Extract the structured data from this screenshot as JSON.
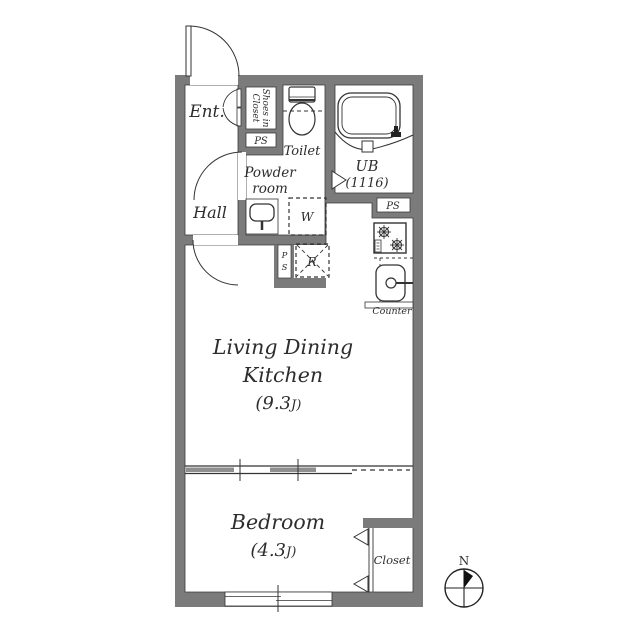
{
  "floorplan": {
    "rooms": {
      "entrance": {
        "label": "Ent."
      },
      "hall": {
        "label": "Hall"
      },
      "shoes_closet": {
        "line1": "Shoes in",
        "line2": "Closet"
      },
      "toilet": {
        "label": "Toilet"
      },
      "powder_room": {
        "line1": "Powder",
        "line2": "room"
      },
      "unit_bath": {
        "line1": "UB",
        "line2": "(1116)"
      },
      "living_dining_kitchen": {
        "line1": "Living Dining",
        "line2": "Kitchen",
        "area_value": "(9.3",
        "area_unit": "J)"
      },
      "bedroom": {
        "label": "Bedroom",
        "area_value": "(4.3",
        "area_unit": "J)"
      },
      "closet": {
        "label": "Closet"
      }
    },
    "labels": {
      "ps_top": "PS",
      "ps_kitchen": "PS",
      "ps_vertical_p": "P",
      "ps_vertical_s": "S",
      "washer": "W",
      "refrigerator": "R",
      "counter": "Counter",
      "compass_north": "N"
    },
    "colors": {
      "wall": "#7b7b7b",
      "line": "#333333",
      "text": "#2d2d2d",
      "background": "#ffffff"
    }
  }
}
